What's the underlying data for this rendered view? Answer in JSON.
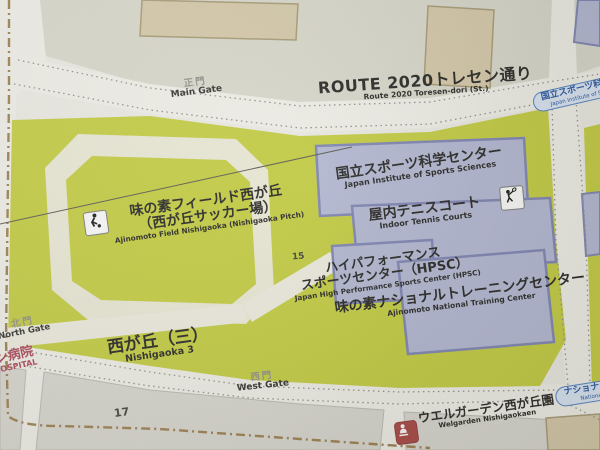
{
  "road": {
    "route2020": {
      "jp": "ROUTE 2020トレセン通り",
      "en": "Route 2020 Toresen-dori (St.)"
    }
  },
  "gates": {
    "main": {
      "jp": "正門",
      "en": "Main Gate"
    },
    "west": {
      "jp": "西門",
      "en": "West Gate"
    },
    "north": {
      "jp": "北門",
      "en": "North Gate"
    }
  },
  "facilities": {
    "field": {
      "jp_line1": "味の素フィールド西が丘",
      "jp_line2": "（西が丘サッカー場）",
      "en": "Ajinomoto Field Nishigaoka (Nishigaoka Pitch)"
    },
    "jiss": {
      "jp": "国立スポーツ科学センター",
      "en": "Japan Institute of Sports Sciences"
    },
    "tennis": {
      "jp": "屋内テニスコート",
      "en": "Indoor Tennis Courts"
    },
    "hpsc": {
      "jp_line1": "ハイパフォーマンス",
      "jp_line2": "スポーツセンター（HPSC）",
      "en": "Japan High Performance Sports Center (HPSC)"
    },
    "ntc": {
      "jp": "味の素ナショナルトレーニングセンター",
      "en": "Ajinomoto National Training Center"
    },
    "welgarden": {
      "jp": "ウエルガーデン西が丘園",
      "en": "Welgarden Nishigaokaen"
    },
    "hospital": {
      "jp": "ョン病院",
      "en": "N HOSPITAL"
    }
  },
  "district": {
    "jp": "西が丘（三）",
    "en": "Nishigaoka 3"
  },
  "bus_stops": {
    "jiss": {
      "jp": "国立スポーツ科学センタ",
      "en": "Japan Institute of Sports Scien"
    },
    "ntc": {
      "jp": "ナショナルト",
      "en": "National"
    }
  },
  "block_numbers": {
    "block15": "15",
    "block17": "17"
  },
  "icons": {
    "soccer": "soccer-player-icon",
    "tennis": "tennis-player-icon",
    "welfare": "welfare-facility-icon"
  },
  "colors": {
    "field_green": "#c5cf3a",
    "ground_gray": "#dcdbce",
    "road_white": "#f4f3ec",
    "building_fill": "#b4b9d6",
    "building_border": "#7b82b4",
    "tan_building": "#d8cba9",
    "track_ring": "#eeecd8",
    "bus_stop_text": "#1d4fa0",
    "hospital_red": "#ad3f54",
    "boundary_brown": "#9b7c4a"
  }
}
